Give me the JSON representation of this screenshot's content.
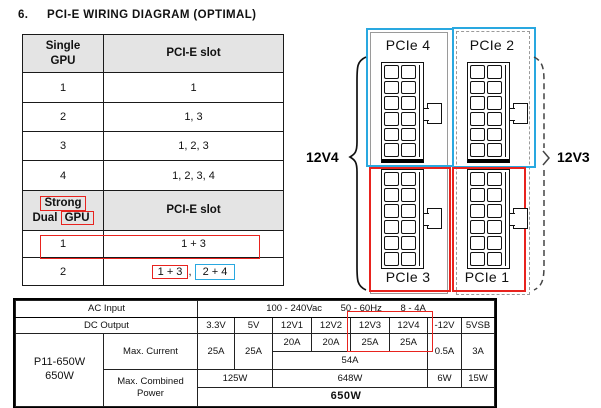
{
  "title": {
    "number": "6.",
    "text": "PCI-E WIRING DIAGRAM (OPTIMAL)"
  },
  "gpu_table": {
    "header1": {
      "col1_line1": "Single",
      "col1_line2": "GPU",
      "col2": "PCI-E slot"
    },
    "rows1": [
      [
        "1",
        "1"
      ],
      [
        "2",
        "1, 3"
      ],
      [
        "3",
        "1, 2, 3"
      ],
      [
        "4",
        "1, 2, 3, 4"
      ]
    ],
    "header2": {
      "col1_line1": "Strong",
      "col1_line2_pre": "Dual",
      "col1_line2_box": "GPU",
      "col2": "PCI-E slot"
    },
    "row5": {
      "gpu": "1",
      "slot": "1 + 3"
    },
    "row6": {
      "gpu": "2",
      "slot_red": "1 + 3",
      "separator": ",",
      "slot_blue": "2 + 4"
    }
  },
  "diagram": {
    "rail_left_label": "12V4",
    "rail_right_label": "12V3",
    "connector_top_left": "PCIe 4",
    "connector_top_right": "PCIe 2",
    "connector_bottom_left": "PCIe 3",
    "connector_bottom_right": "PCIe 1"
  },
  "spec_table": {
    "ac_input_label": "AC Input",
    "ac_values": [
      "100 - 240Vac",
      "50 - 60Hz",
      "8 - 4A"
    ],
    "dc_output_label": "DC Output",
    "rail_headers": [
      "3.3V",
      "5V",
      "12V1",
      "12V2",
      "12V3",
      "12V4",
      "-12V",
      "5VSB"
    ],
    "model_line1": "P11-650W",
    "model_line2": "650W",
    "max_current_label": "Max. Current",
    "max_current": {
      "v33": "25A",
      "v5": "25A",
      "v12_1": "20A",
      "v12_2": "20A",
      "v12_3": "25A",
      "v12_4": "25A",
      "v12_combined": "54A",
      "neg12": "0.5A",
      "sb": "3A"
    },
    "max_power_label_line1": "Max. Combined",
    "max_power_label_line2": "Power",
    "max_power": {
      "p33_5": "125W",
      "p12": "648W",
      "pneg12": "6W",
      "psb": "15W",
      "total": "650W"
    }
  },
  "colors": {
    "highlight_red": "#e8231e",
    "highlight_blue": "#29a8e0",
    "box_gray": "#9a9a9a",
    "header_bg": "#e4e4e4"
  }
}
